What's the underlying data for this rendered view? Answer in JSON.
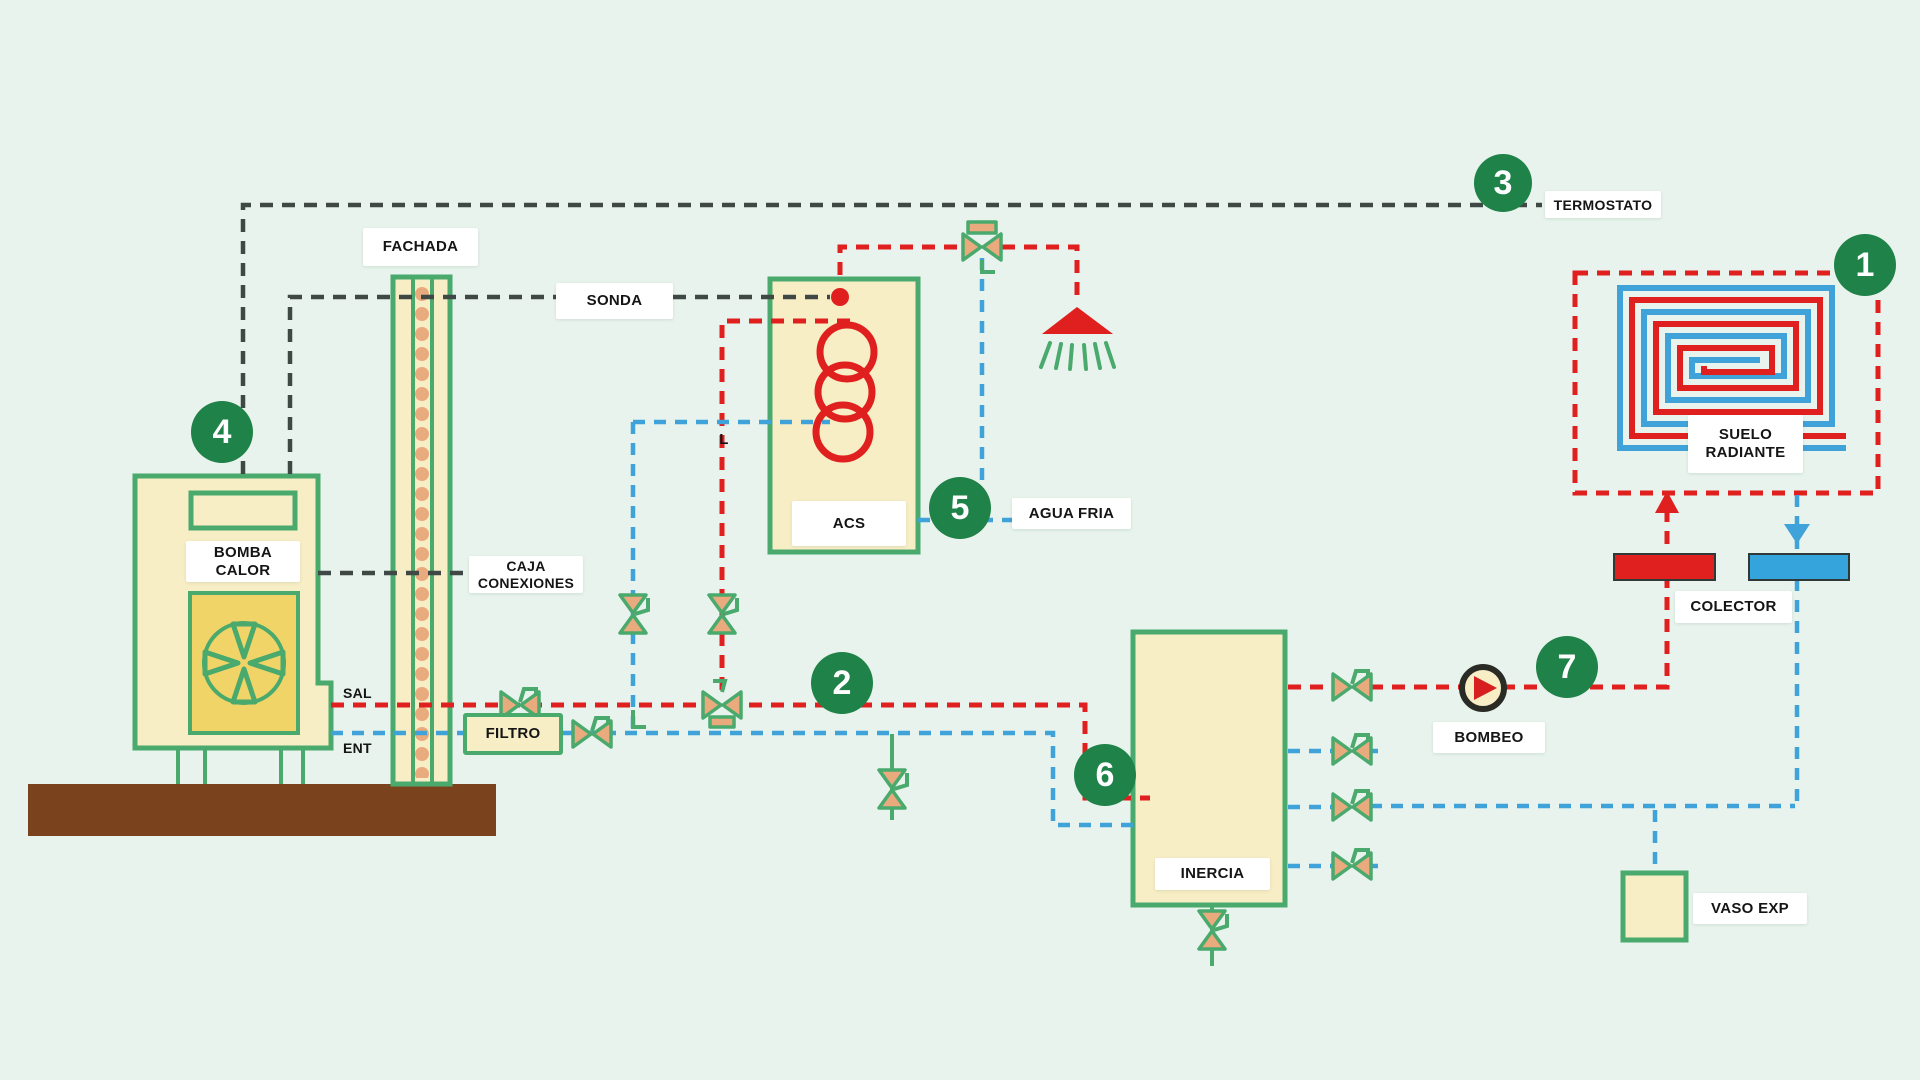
{
  "diagram": {
    "type": "heating-installation-schematic",
    "labels": {
      "fachada": "FACHADA",
      "sonda": "SONDA",
      "termostato": "TERMOSTATO",
      "bomba_calor_l1": "BOMBA",
      "bomba_calor_l2": "CALOR",
      "caja_l1": "CAJA",
      "caja_l2": "CONEXIONES",
      "filtro": "FILTRO",
      "acs": "ACS",
      "agua_fria": "AGUA FRIA",
      "sal": "SAL",
      "ent": "ENT",
      "l_mark": "L",
      "inercia": "INERCIA",
      "bombeo": "BOMBEO",
      "colector": "COLECTOR",
      "suelo_l1": "SUELO",
      "suelo_l2": "RADIANTE",
      "vaso_exp": "VASO EXP"
    },
    "markers": [
      {
        "n": "1"
      },
      {
        "n": "2"
      },
      {
        "n": "3"
      },
      {
        "n": "4"
      },
      {
        "n": "5"
      },
      {
        "n": "6"
      },
      {
        "n": "7"
      }
    ],
    "icons": [
      "fan-icon",
      "shower-icon",
      "pump-icon",
      "valve-icon",
      "coil-icon",
      "arrow-up-icon",
      "arrow-down-icon",
      "sensor-dot-icon"
    ],
    "colors": {
      "background": "#e7f3ec",
      "pipe_green": "#4aa96c",
      "marker_green": "#1f8248",
      "tank_cream": "#f8eec6",
      "fan_panel_yellow": "#f0d468",
      "ground_brown": "#7a431d",
      "hot_red": "#e01f1f",
      "cold_blue": "#3fa3da",
      "collector_blue": "#35a3dc",
      "control_black": "#3f4845",
      "valve_tan": "#e9ab7d",
      "label_white": "#ffffff"
    }
  }
}
